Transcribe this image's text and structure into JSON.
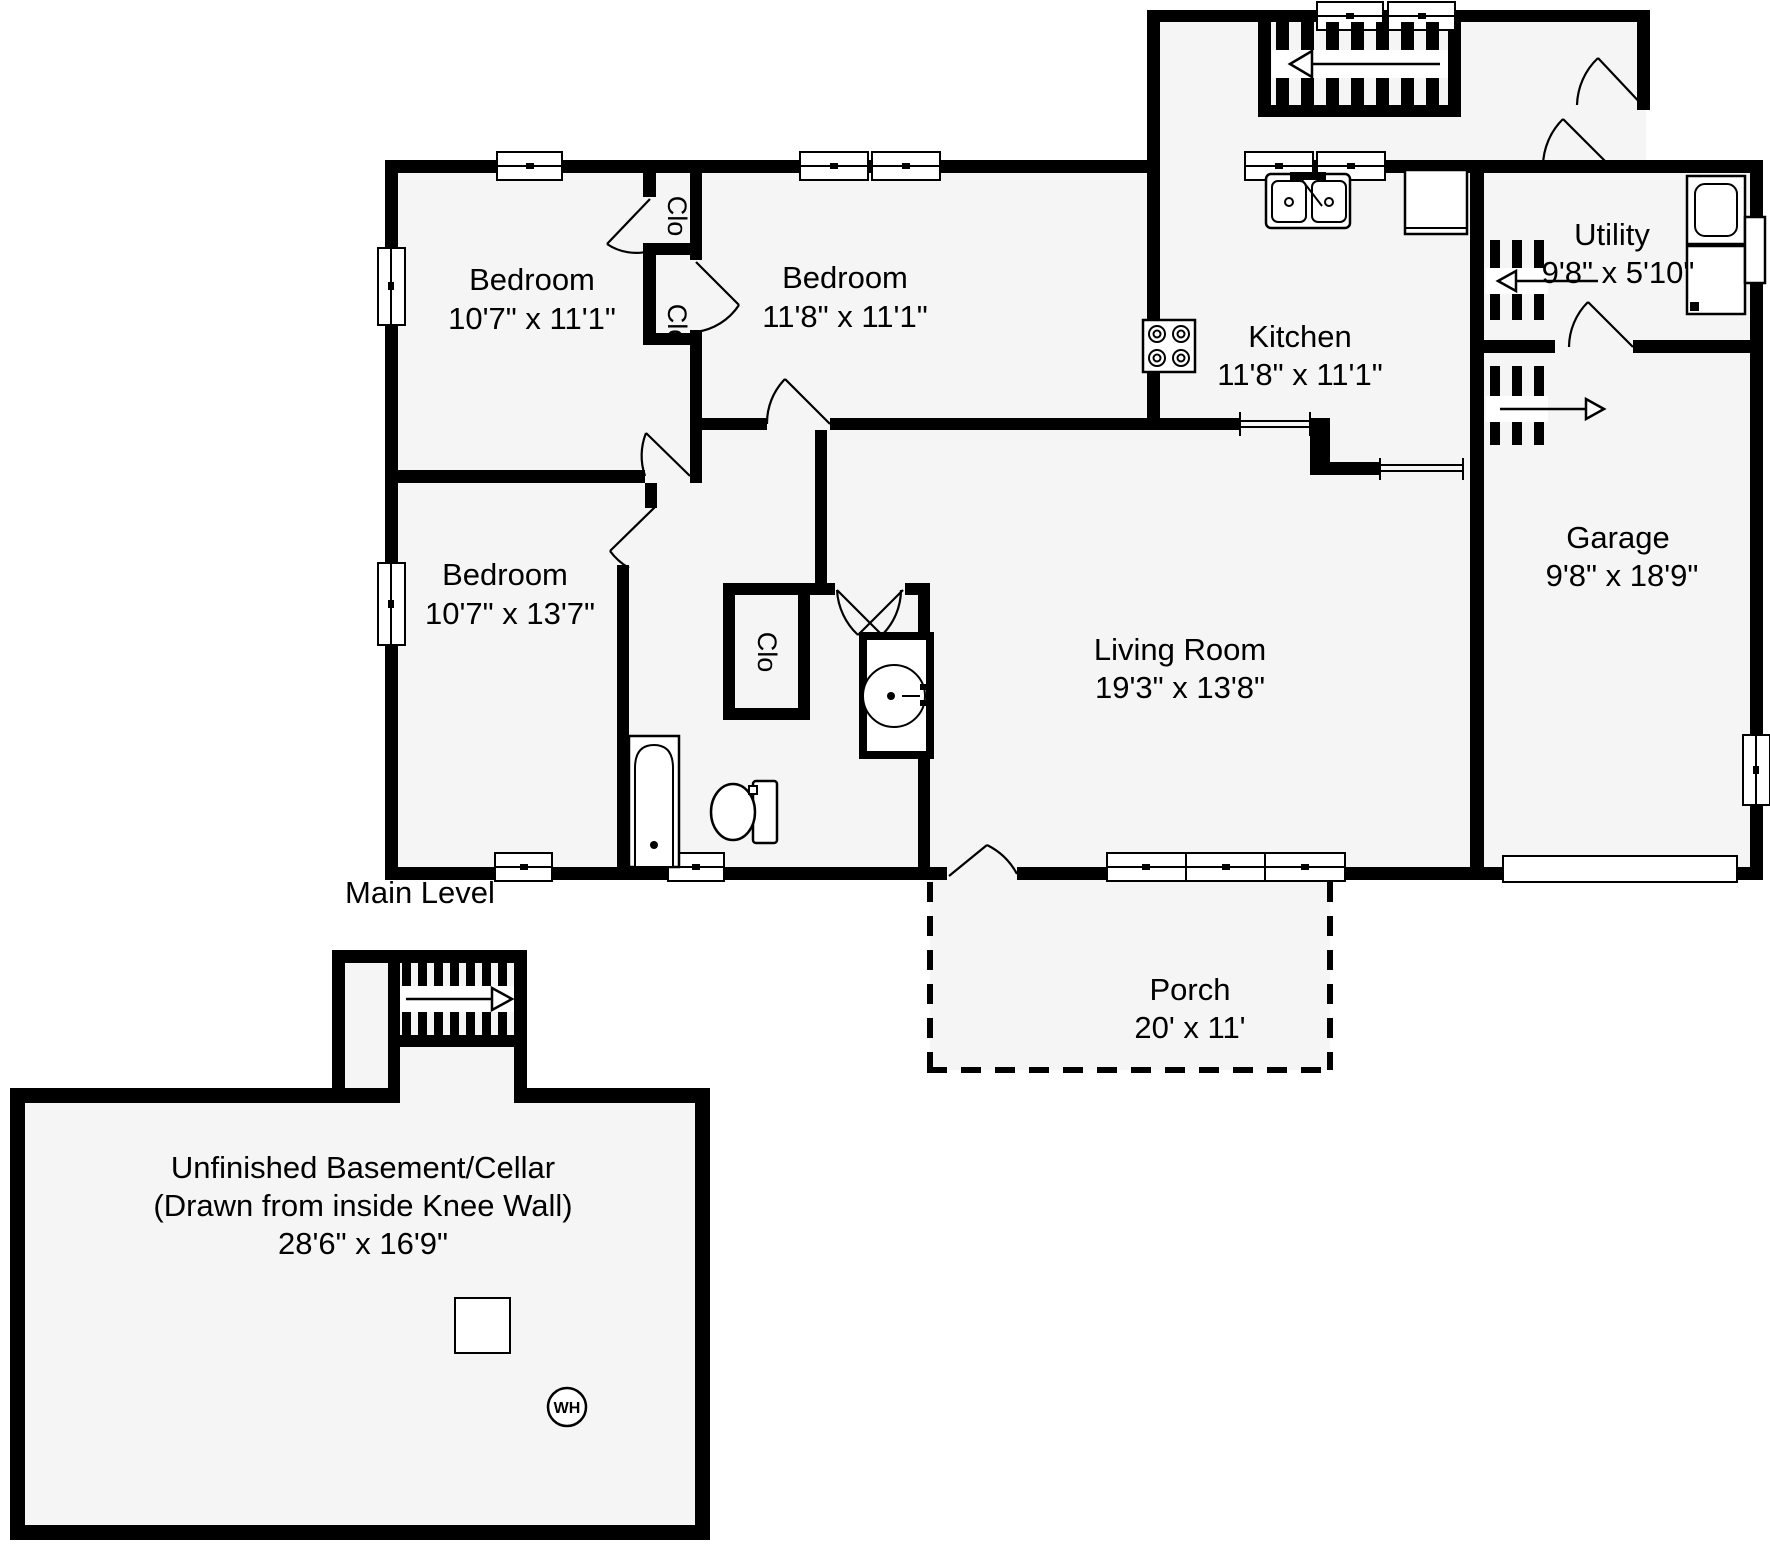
{
  "main_level": {
    "caption": "Main Level",
    "rooms": {
      "bedroom1": {
        "name": "Bedroom",
        "dims": "10'7\" x 11'1\""
      },
      "bedroom2": {
        "name": "Bedroom",
        "dims": "11'8\" x 11'1\""
      },
      "bedroom3": {
        "name": "Bedroom",
        "dims": "10'7\" x 13'7\""
      },
      "kitchen": {
        "name": "Kitchen",
        "dims": "11'8\" x 11'1\""
      },
      "living_room": {
        "name": "Living Room",
        "dims": "19'3\" x 13'8\""
      },
      "utility": {
        "name": "Utility",
        "dims": "9'8\" x 5'10\""
      },
      "garage": {
        "name": "Garage",
        "dims": "9'8\" x 18'9\""
      },
      "porch": {
        "name": "Porch",
        "dims": "20' x 11'"
      }
    },
    "closets": {
      "closet1": "Clo",
      "closet2": "Clo",
      "closet3": "Clo"
    }
  },
  "basement_level": {
    "room": {
      "name": "Unfinished Basement/Cellar",
      "note": "(Drawn from inside Knee Wall)",
      "dims": "28'6\" x 16'9\""
    },
    "water_heater": "WH"
  }
}
